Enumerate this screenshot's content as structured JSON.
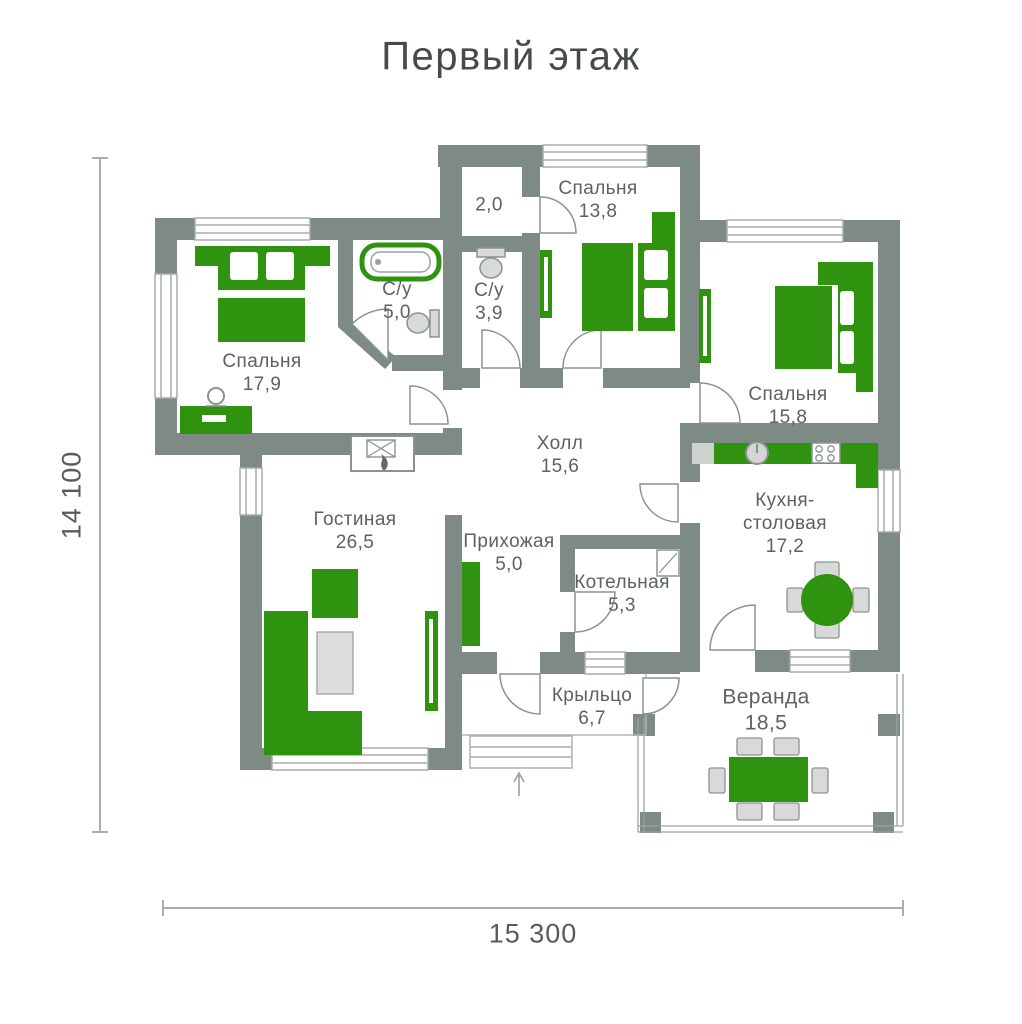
{
  "title": "Первый этаж",
  "dimensions": {
    "height_label": "14 100",
    "width_label": "15 300"
  },
  "rooms": [
    {
      "name": "Спальня",
      "name2": "",
      "area": "13,8"
    },
    {
      "name": "",
      "name2": "",
      "area": "2,0"
    },
    {
      "name": "Спальня",
      "name2": "",
      "area": "17,9"
    },
    {
      "name": "С/у",
      "name2": "",
      "area": "5,0"
    },
    {
      "name": "С/у",
      "name2": "",
      "area": "3,9"
    },
    {
      "name": "Спальня",
      "name2": "",
      "area": "15,8"
    },
    {
      "name": "Холл",
      "name2": "",
      "area": "15,6"
    },
    {
      "name": "Гостиная",
      "name2": "",
      "area": "26,5"
    },
    {
      "name": "Прихожая",
      "name2": "",
      "area": "5,0"
    },
    {
      "name": "Котельная",
      "name2": "",
      "area": "5,3"
    },
    {
      "name": "Кухня-",
      "name2": "столовая",
      "area": "17,2"
    },
    {
      "name": "Крыльцо",
      "name2": "",
      "area": "6,7"
    },
    {
      "name": "Веранда",
      "name2": "",
      "area": "18,5"
    }
  ],
  "colors": {
    "furniture_green": "#309310",
    "wall_gray": "#7e8a84",
    "label_text": "#5b625f",
    "fixture_gray": "#d8dad9"
  }
}
